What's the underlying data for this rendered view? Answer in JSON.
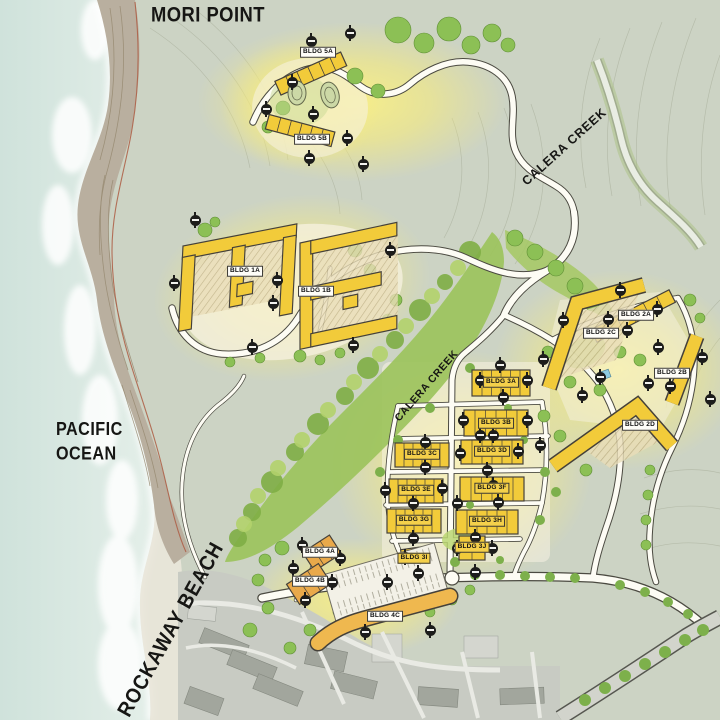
{
  "labels": {
    "mori_point": "MORI POINT",
    "pacific_line1": "PACIFIC",
    "pacific_line2": "OCEAN",
    "rockaway_beach": "ROCKAWAY BEACH",
    "calera_creek_upper": "CALERA CREEK",
    "calera_creek_central": "CALERA CREEK"
  },
  "buildings": [
    {
      "label": "BLDG 5A"
    },
    {
      "label": "BLDG 5B"
    },
    {
      "label": "BLDG 1A"
    },
    {
      "label": "BLDG 1B"
    },
    {
      "label": "BLDG 2A"
    },
    {
      "label": "BLDG 2C"
    },
    {
      "label": "BLDG 2B"
    },
    {
      "label": "BLDG 2D"
    },
    {
      "label": "BLDG 3A"
    },
    {
      "label": "BLDG 3B"
    },
    {
      "label": "BLDG 3C"
    },
    {
      "label": "BLDG 3D"
    },
    {
      "label": "BLDG 3E"
    },
    {
      "label": "BLDG 3F"
    },
    {
      "label": "BLDG 3G"
    },
    {
      "label": "BLDG 3H"
    },
    {
      "label": "BLDG 3I"
    },
    {
      "label": "BLDG 3J"
    },
    {
      "label": "BLDG 4A"
    },
    {
      "label": "BLDG 4B"
    },
    {
      "label": "BLDG 4C"
    }
  ],
  "icons": {
    "marker": "section-marker-icon"
  },
  "colors": {
    "building_yellow": "#f2cb3a",
    "accent_orange": "#e9a94a",
    "glow": "#f7ec7e",
    "vegetation": "#9cc35c",
    "ocean": "#d8e7e1",
    "cliff": "#b9af9f",
    "terrain": "#ccd3c4",
    "urban": "#c8cbc3",
    "road": "#fdfcf4",
    "ink": "#1d1d1b"
  }
}
